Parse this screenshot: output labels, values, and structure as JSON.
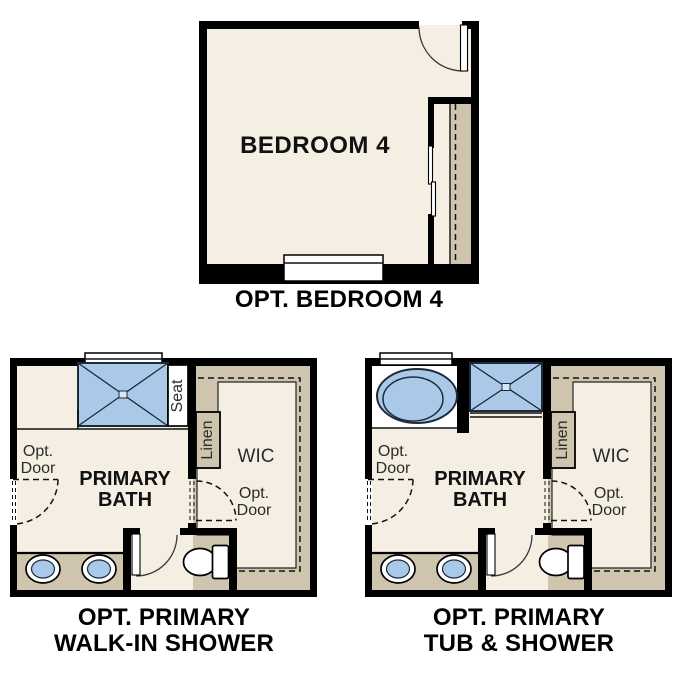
{
  "colors": {
    "floor_cream": "#f4efe2",
    "cabinet_tan": "#cfc5af",
    "fixture_blue": "#aac9e9",
    "fixture_outline": "#1c2a3a",
    "wall_black": "#000000"
  },
  "bedroom_plan": {
    "room_label": "BEDROOM 4",
    "caption": "OPT. BEDROOM 4"
  },
  "walkin_shower_plan": {
    "caption_line1": "OPT. PRIMARY",
    "caption_line2": "WALK-IN SHOWER",
    "labels": {
      "seat": "Seat",
      "linen": "Linen",
      "wic": "WIC",
      "bath_line1": "PRIMARY",
      "bath_line2": "BATH",
      "opt_door_line1": "Opt.",
      "opt_door_line2": "Door",
      "wic_opt_door_line1": "Opt.",
      "wic_opt_door_line2": "Door"
    }
  },
  "tub_shower_plan": {
    "caption_line1": "OPT. PRIMARY",
    "caption_line2": "TUB & SHOWER",
    "labels": {
      "linen": "Linen",
      "wic": "WIC",
      "bath_line1": "PRIMARY",
      "bath_line2": "BATH",
      "opt_door_line1": "Opt.",
      "opt_door_line2": "Door",
      "wic_opt_door_line1": "Opt.",
      "wic_opt_door_line2": "Door"
    }
  }
}
